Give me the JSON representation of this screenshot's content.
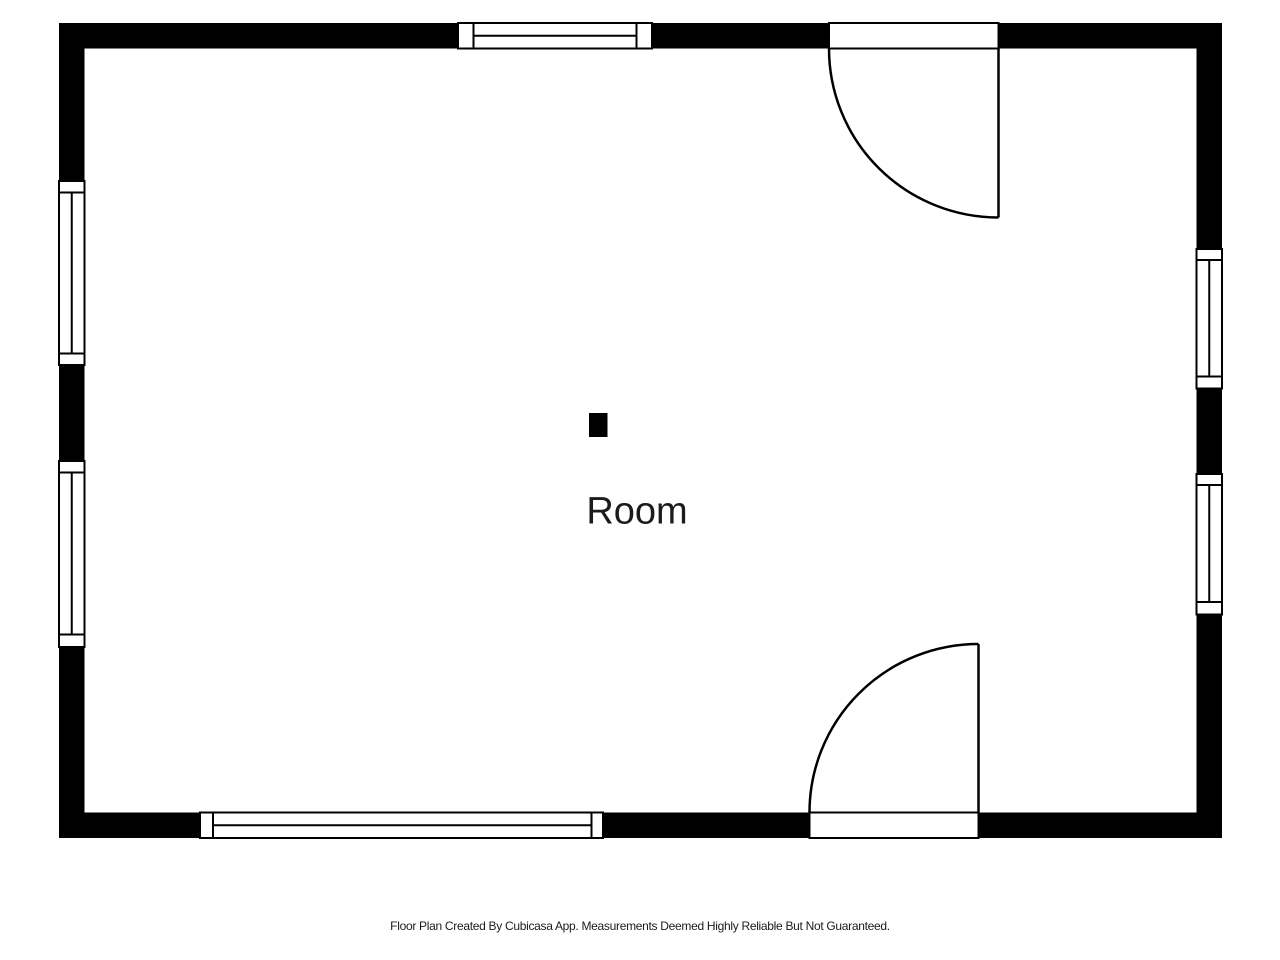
{
  "floor_plan": {
    "room_label": "Room",
    "colors": {
      "wall": "#000000",
      "background": "#ffffff",
      "label_text": "#1b1b1b",
      "footer_text": "#1b1b1b"
    }
  },
  "footer": {
    "disclaimer": "Floor Plan Created By Cubicasa App. Measurements Deemed Highly Reliable But Not Guaranteed."
  }
}
